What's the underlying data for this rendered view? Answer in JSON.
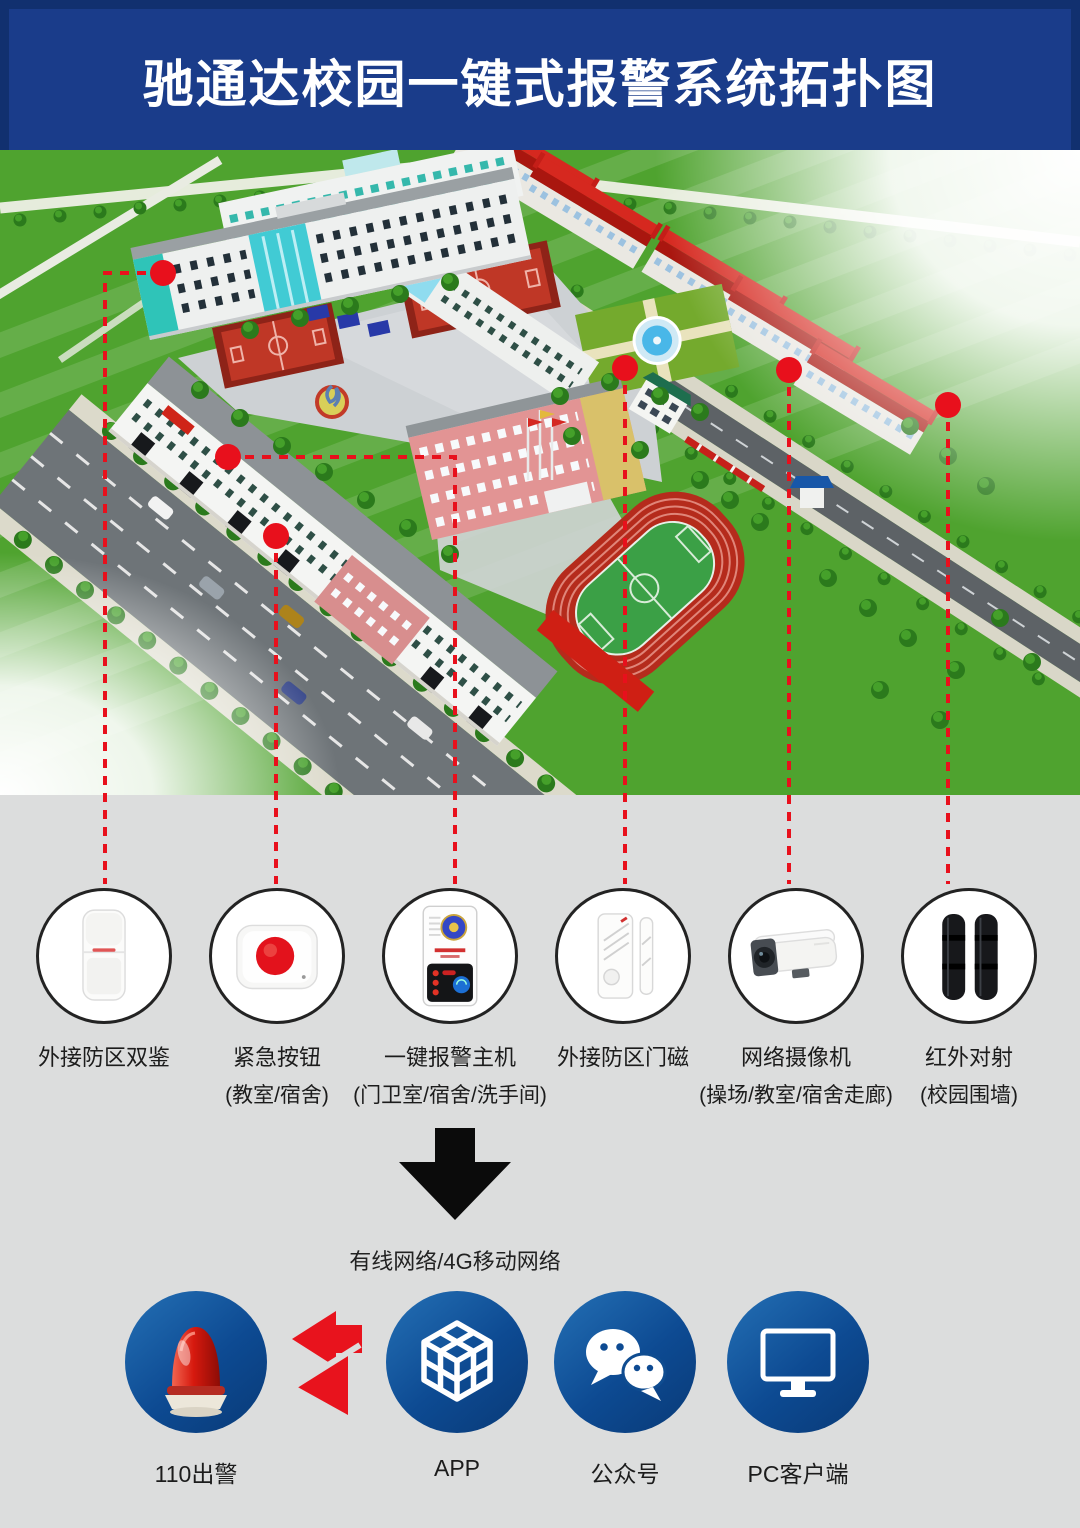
{
  "header": {
    "title": "驰通达校园一键式报警系统拓扑图"
  },
  "devices": [
    {
      "label": "外接防区双鉴",
      "sublabel": "",
      "icon": "pir-detector-icon"
    },
    {
      "label": "紧急按钮",
      "sublabel": "(教室/宿舍)",
      "icon": "panic-button-icon"
    },
    {
      "label": "一键报警主机",
      "sublabel": "(门卫室/宿舍/洗手间)",
      "icon": "alarm-host-icon"
    },
    {
      "label": "外接防区门磁",
      "sublabel": "",
      "icon": "door-magnet-icon"
    },
    {
      "label": "网络摄像机",
      "sublabel": "(操场/教室/宿舍走廊)",
      "icon": "network-camera-icon"
    },
    {
      "label": "红外对射",
      "sublabel": "(校园围墙)",
      "icon": "infrared-beam-icon"
    }
  ],
  "network": {
    "label": "有线网络/4G移动网络"
  },
  "outputs": [
    {
      "label": "110出警",
      "icon": "alarm-beacon-icon"
    },
    {
      "label": "APP",
      "icon": "app-cube-icon"
    },
    {
      "label": "公众号",
      "icon": "wechat-icon"
    },
    {
      "label": "PC客户端",
      "icon": "pc-monitor-icon"
    }
  ],
  "colors": {
    "header_bg": "#1a3c8a",
    "header_frame": "#11306f",
    "panel_bg": "#dcdddd",
    "accent_red": "#e8131d",
    "dash_red": "#e8101c",
    "circle_border": "#232323",
    "output_blue_light": "#2470b5",
    "output_blue_dark": "#093a77"
  }
}
